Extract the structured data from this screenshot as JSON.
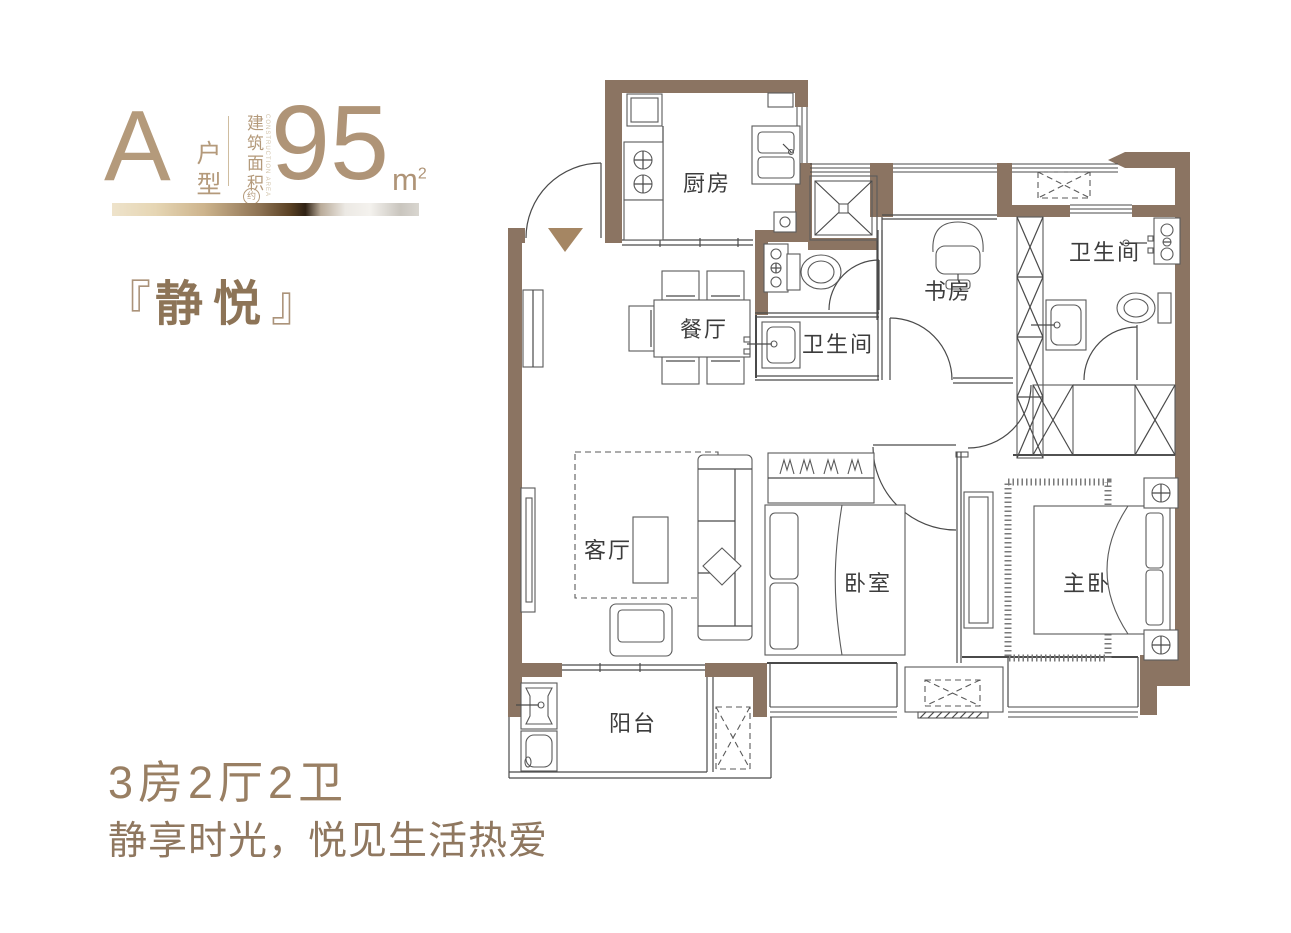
{
  "header": {
    "type_letter": "A",
    "type_label": "户型",
    "area_label_cn": "建筑面积",
    "area_label_en": "CONSTRUCTION AREA",
    "area_approx": "约",
    "area_value": "95",
    "area_unit": "m",
    "area_exponent": "2",
    "name_bracket_open": "『",
    "name_text": "静悦",
    "name_bracket_close": "』"
  },
  "rooms": {
    "kitchen": "厨房",
    "dining": "餐厅",
    "bathroom_main": "卫生间",
    "bathroom_ensuite": "卫生间",
    "study": "书房",
    "living": "客厅",
    "bedroom": "卧室",
    "master_bedroom": "主卧",
    "balcony": "阳台"
  },
  "footer": {
    "layout_summary": "3房2厅2卫",
    "slogan": "静享时光，悦见生活热爱"
  },
  "colors": {
    "wall": "#8b7462",
    "accent_text": "#b0977a",
    "dark_text": "#8d7457",
    "line": "#4a4a4a",
    "label": "#3c3c3c"
  }
}
